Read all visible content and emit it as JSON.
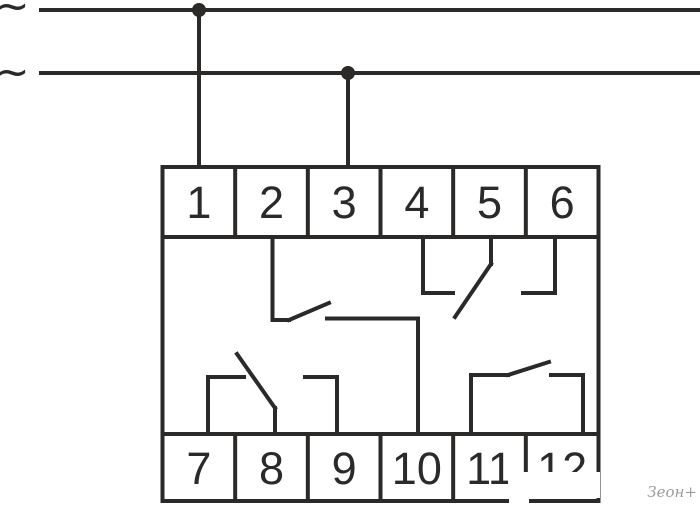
{
  "diagram": {
    "background": "#ffffff",
    "line_color": "#2b2a29",
    "supply": {
      "phase_symbol_top": "~",
      "phase_symbol_bottom": "~"
    },
    "terminals": {
      "top": [
        "1",
        "2",
        "3",
        "4",
        "5",
        "6"
      ],
      "bottom": [
        "7",
        "8",
        "9",
        "10",
        "11",
        "12"
      ]
    },
    "watermark": {
      "text": "Зеон+",
      "color": "#9b9b9b"
    },
    "geometry": {
      "canvas": [
        700,
        509
      ],
      "supply_lines": [
        [
          41,
          10,
          700,
          10
        ],
        [
          41,
          73,
          700,
          73
        ]
      ],
      "junction_dots": [
        [
          199,
          10
        ],
        [
          348,
          73
        ]
      ],
      "dot_radius": 7,
      "feed_wires": [
        [
          199,
          10,
          199,
          167
        ],
        [
          348,
          73,
          348,
          167
        ]
      ],
      "block": {
        "x": 162.5,
        "y": 167,
        "w": 436,
        "h": 334,
        "top_row_h": 70,
        "bottom_row_h": 67
      },
      "contact_wires": [
        [
          272.5,
          237,
          272.5,
          320
        ],
        [
          272.5,
          320,
          289,
          320
        ],
        [
          289,
          320,
          329,
          303
        ],
        [
          327,
          318.5,
          418,
          318.5
        ],
        [
          418,
          318.5,
          418,
          434
        ],
        [
          423,
          237,
          423,
          293
        ],
        [
          423,
          293,
          453,
          293
        ],
        [
          491,
          237,
          491,
          264
        ],
        [
          491,
          264,
          455,
          317
        ],
        [
          555,
          237,
          555,
          293
        ],
        [
          555,
          293,
          523,
          293
        ],
        [
          208,
          434,
          208,
          377
        ],
        [
          208,
          377,
          244,
          377
        ],
        [
          275,
          434,
          275,
          408
        ],
        [
          275,
          408,
          237,
          354
        ],
        [
          337,
          434,
          337,
          377
        ],
        [
          337,
          377,
          305,
          377
        ],
        [
          471,
          434,
          471,
          375
        ],
        [
          471,
          375,
          508,
          375
        ],
        [
          508,
          375,
          549,
          362
        ],
        [
          551,
          375,
          583,
          375
        ],
        [
          583,
          375,
          583,
          434
        ]
      ],
      "patches": [
        [
          508,
          472,
          92,
          26
        ],
        [
          509,
          496,
          20,
          12
        ]
      ]
    }
  }
}
